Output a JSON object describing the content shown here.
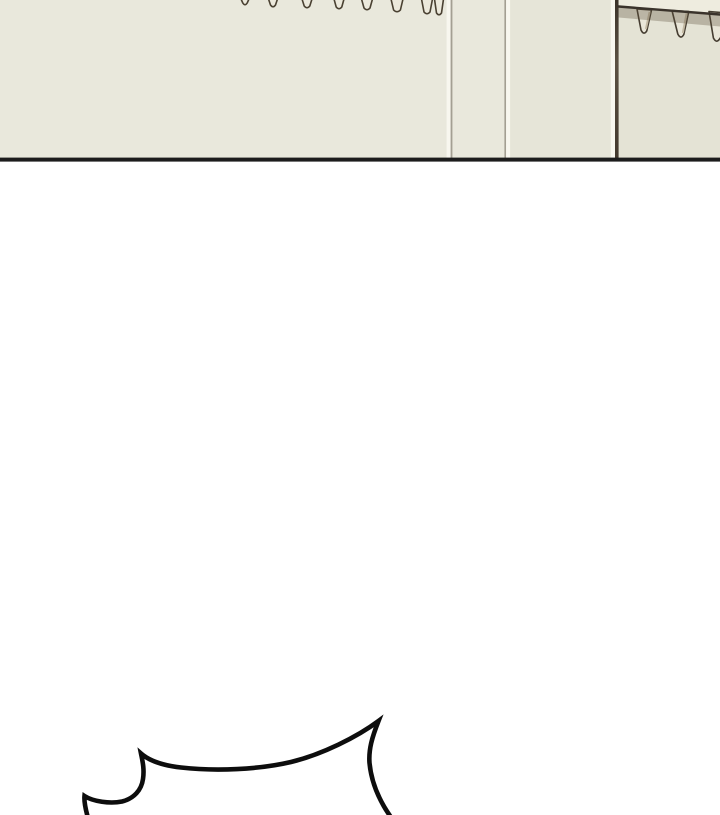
{
  "scene": {
    "type": "comic-panel",
    "description": "Webtoon panel strip: cream interior wall with vertical panel seams, a wall-mounted peg rack with three hanging pegs at the upper right, a row of eight small peg tips along the top edge, a thick black panel border, a large white gutter, and the top edge of a spiky shout-style speech bubble entering from the bottom of the frame",
    "speech_bubble": {
      "style": "spiky-shout",
      "visible_text": ""
    },
    "wall": {
      "peg_count": 3,
      "tip_count": 8,
      "seam_count": 3
    }
  },
  "colors": {
    "page_bg": "#ffffff",
    "wall_left": "#e9e8dc",
    "wall_mid": "#e6e5d8",
    "wall_right": "#e4e3d5",
    "seam_light": "#f8f7ef",
    "seam_gray": "#a39f92",
    "seam_dark_top": "#3b332a",
    "seam_dark_mid": "#5c5143",
    "seam_dark_bottom": "#43392e",
    "rail_face": "#eeecdf",
    "rail_line": "#3a332b",
    "rack_shadow": "rgba(95,83,62,0.33)",
    "peg_fill": "#e9e6d8",
    "peg_outline": "#453d31",
    "tip_fill": "#ece9dc",
    "tip_outline": "#4a4132",
    "panel_border": "#1c1c1c",
    "bubble_stroke": "#0d0d0d"
  }
}
